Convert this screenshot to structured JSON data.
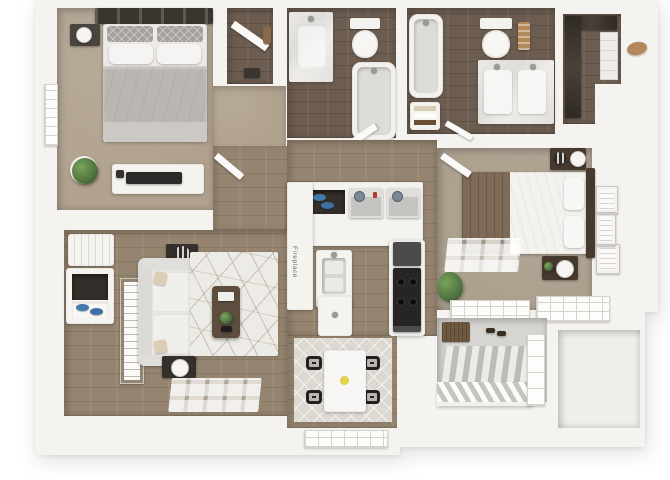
{
  "labels": {
    "fireplace": "Fireplace"
  },
  "colors": {
    "wall": "#f5f3f0",
    "carpet": "#b1a28f",
    "carpet2": "#aca08e",
    "wood": "#95846f",
    "woodDark": "#6d5d50",
    "concrete": "#d7d5d1",
    "furnWhite": "#f4f3f0",
    "charcoal": "#3b352f",
    "headboard": "#46392e",
    "beddingGray": "#bab7b3",
    "beddingWhite": "#f3f2ef",
    "duvetBrown": "#7e6a57",
    "rug": "#edebe5",
    "rugDining": "#dcd9d2",
    "tableWood": "#5d4d3f",
    "plant": "#4f7440",
    "blue": "#4579ad",
    "stove": "#262524",
    "mat": "#6f5a41",
    "gold": "#b3885a"
  },
  "rooms": [
    {
      "name": "bedroom-1",
      "items": [
        "headboard-shelf",
        "bed",
        "nightstand",
        "window",
        "plant",
        "tv-console"
      ]
    },
    {
      "name": "closet-1",
      "items": [
        "leaning-mirror",
        "storage-box",
        "wood-panel"
      ]
    },
    {
      "name": "bathroom-1",
      "items": [
        "marble-vanity",
        "toilet",
        "bathtub",
        "door"
      ]
    },
    {
      "name": "bathroom-2",
      "items": [
        "bathtub",
        "linen-shelf",
        "toilet",
        "towel-rack",
        "double-sink-vanity",
        "door"
      ]
    },
    {
      "name": "walk-in-closet",
      "items": [
        "hanging-clothes",
        "shelving",
        "round-mirror"
      ]
    },
    {
      "name": "bedroom-2",
      "items": [
        "bed",
        "nightstand",
        "nightstand",
        "table-lamp",
        "wall-frames",
        "window-light",
        "plant",
        "windows"
      ]
    },
    {
      "name": "kitchen-laundry",
      "items": [
        "fireplace-column",
        "towel-cubby",
        "washer",
        "dryer",
        "sink-island",
        "counter",
        "stove"
      ]
    },
    {
      "name": "living-room",
      "items": [
        "bench",
        "entry-closet",
        "shoes",
        "leaning-art",
        "sofa",
        "side-table",
        "floor-lamp",
        "rug",
        "coffee-table",
        "window-light"
      ]
    },
    {
      "name": "dining-nook",
      "items": [
        "rug",
        "table",
        "chairs",
        "bay-window"
      ]
    },
    {
      "name": "balcony",
      "items": [
        "doormat",
        "sandals",
        "striped-rug",
        "railing",
        "sliding-door"
      ]
    },
    {
      "name": "storage-room",
      "items": []
    }
  ]
}
